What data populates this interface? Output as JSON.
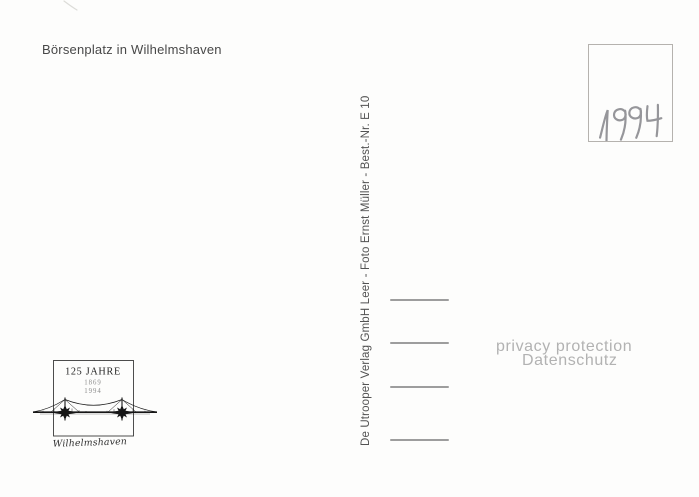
{
  "postcard": {
    "caption": "Börsenplatz in Wilhelmshaven",
    "publisher_imprint": "De Utrooper Verlag GmbH Leer - Foto Ernst Müller - Best.-Nr. E 10",
    "stamp_box": {
      "handwritten_year": "1994"
    },
    "address_line_count": 4
  },
  "anniversary_logo": {
    "title": "125 JAHRE",
    "founding_year": "1869",
    "anniversary_year": "1994",
    "signature": "Wilhelmshaven"
  },
  "watermark": {
    "line1": "privacy protection",
    "line2": "Datenschutz"
  },
  "colors": {
    "paper": "#fdfdfc",
    "caption_ink": "#484848",
    "imprint_ink": "#525252",
    "address_line": "#9d9d9d",
    "stamp_border": "#b5b2ae",
    "handwriting": "#96969a",
    "watermark": "#b2b2b2",
    "logo_ink": "#161616"
  }
}
